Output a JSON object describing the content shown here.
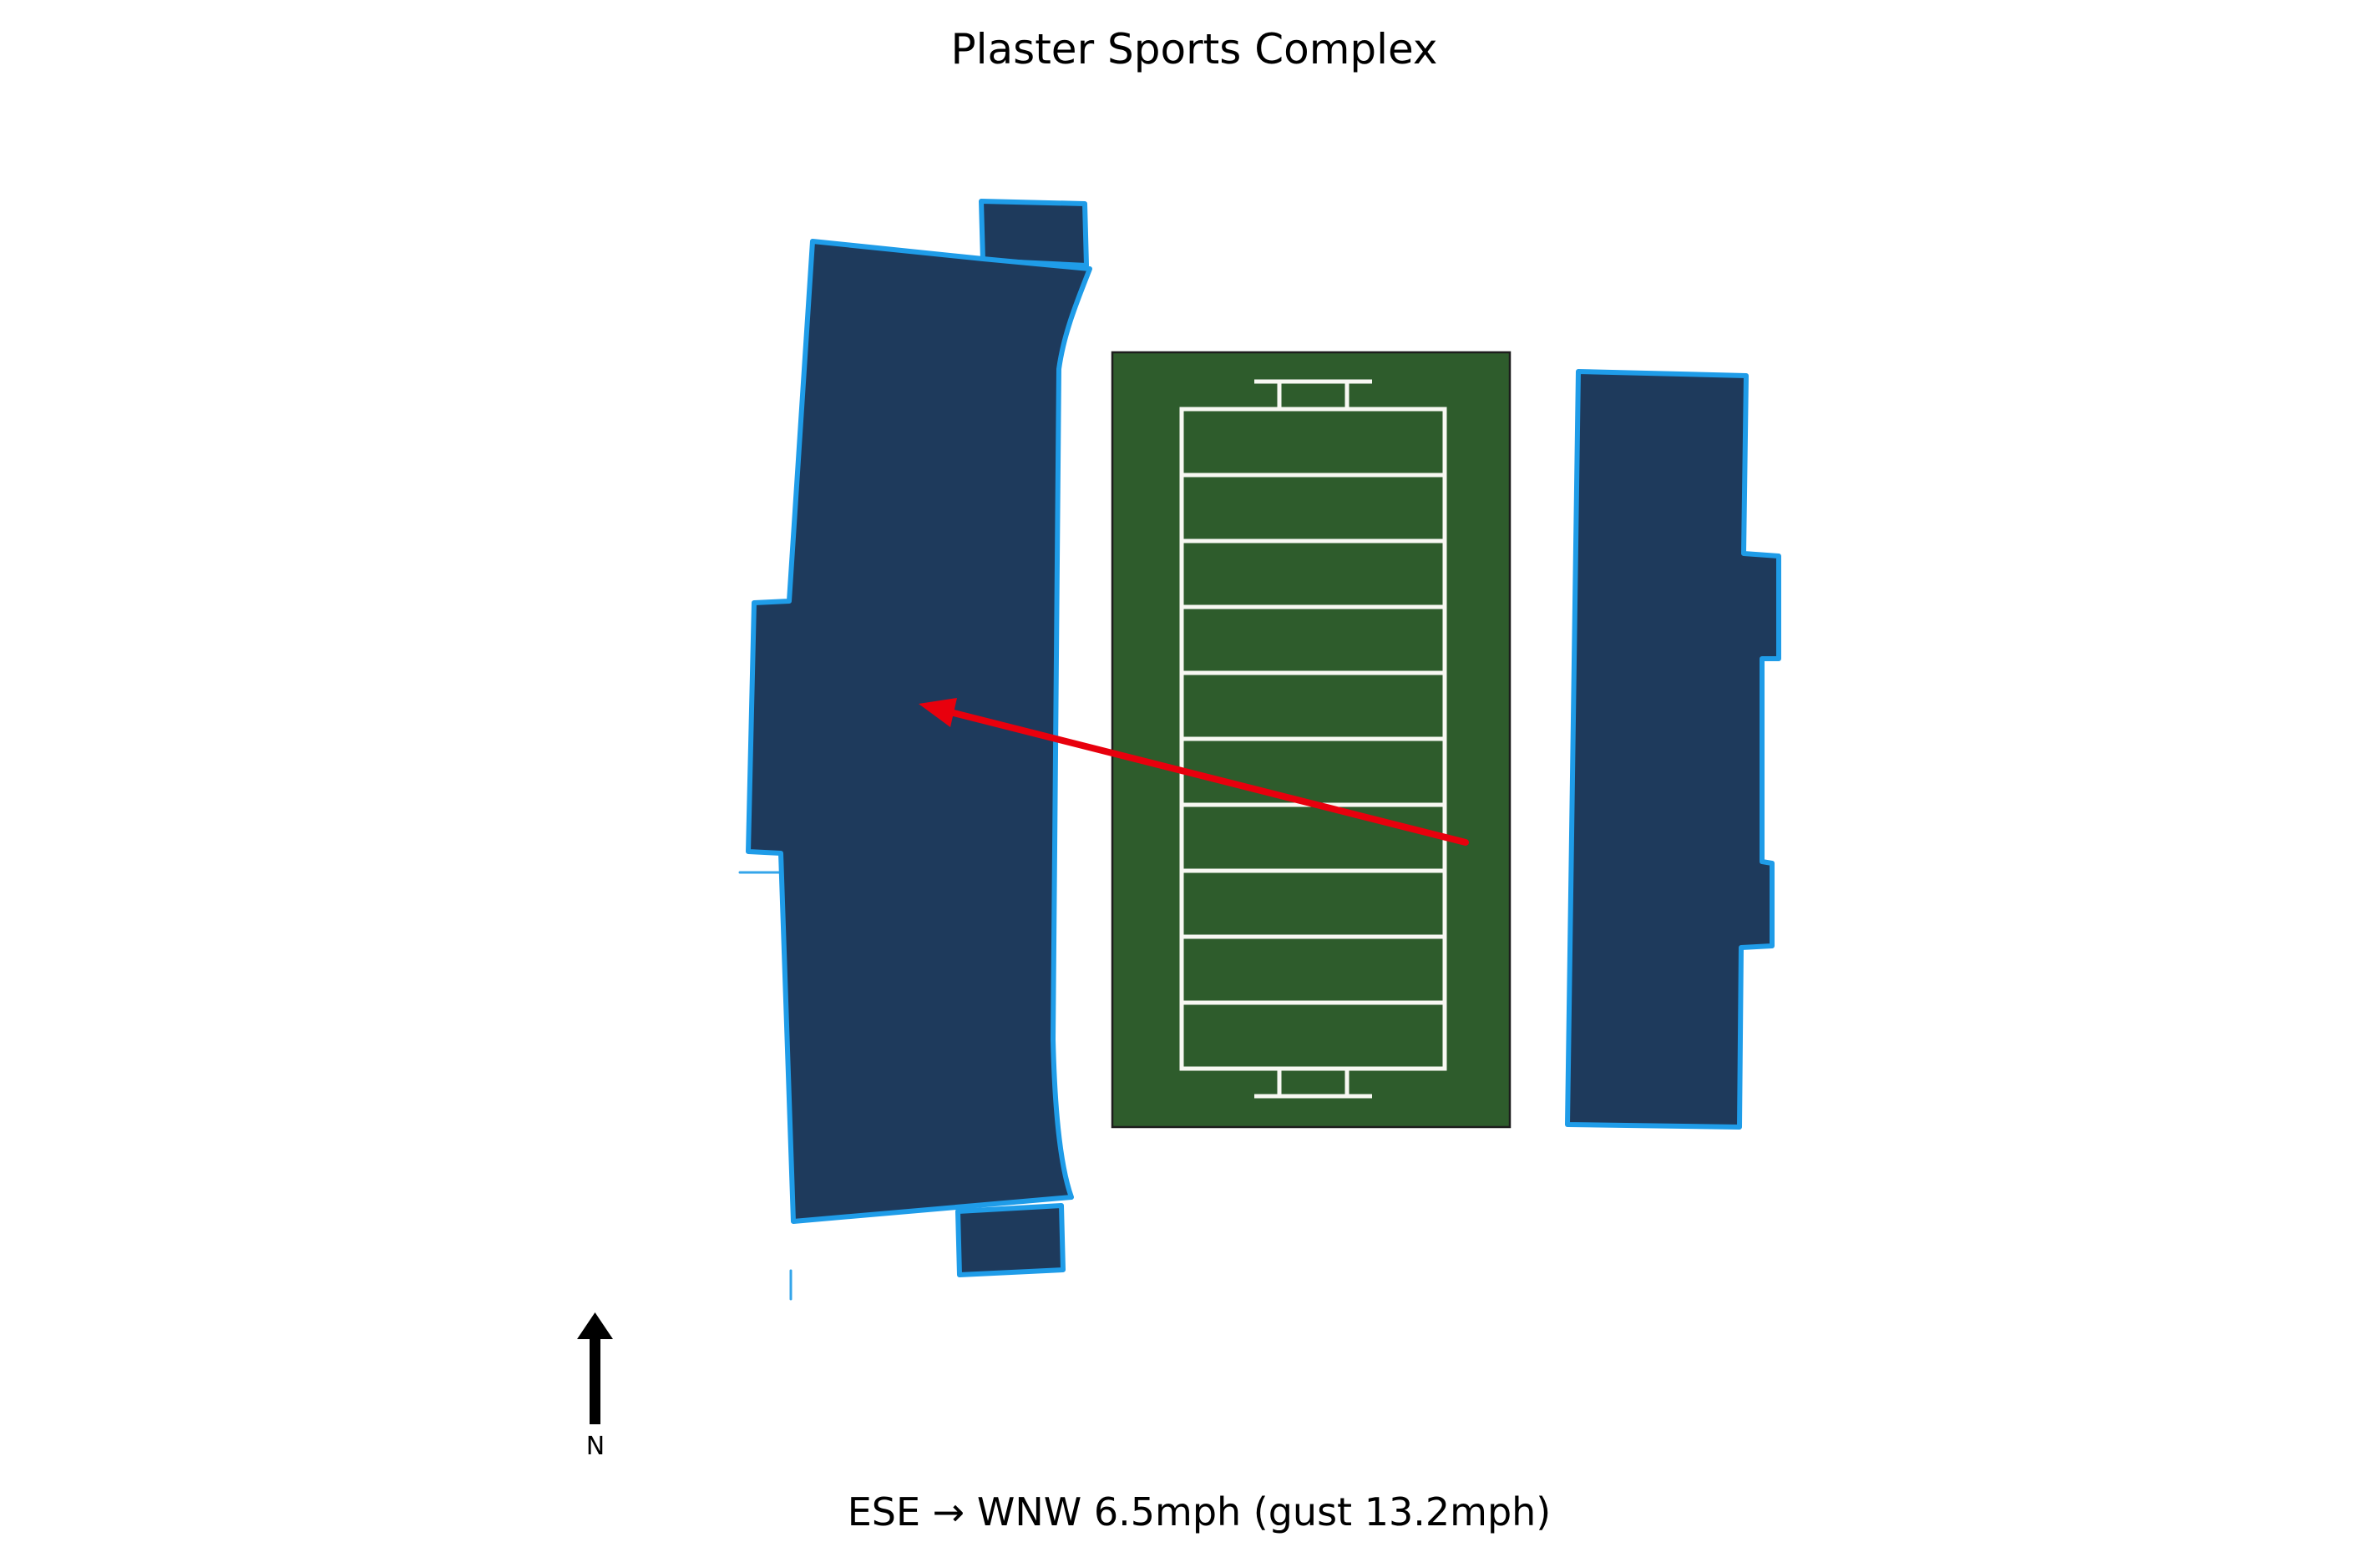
{
  "title": "Plaster Sports Complex",
  "caption": "ESE → WNW 6.5mph (gust 13.2mph)",
  "wind": {
    "direction_from": "ESE",
    "direction_to": "WNW",
    "speed": "6.5mph",
    "gust": "13.2mph"
  },
  "compass": {
    "label": "N"
  },
  "field": {
    "yard_bands": 10
  },
  "colors": {
    "background": "#ffffff",
    "stand_fill": "#1e3a5c",
    "stand_outline": "#1f9ce8",
    "turf_green": "#2e5c2c",
    "turf_edge": "#1d1d1d",
    "field_line_white": "#f8f8f3",
    "wind_arrow_red": "#e8000d",
    "compass_color": "#000000",
    "text_color": "#000000"
  }
}
